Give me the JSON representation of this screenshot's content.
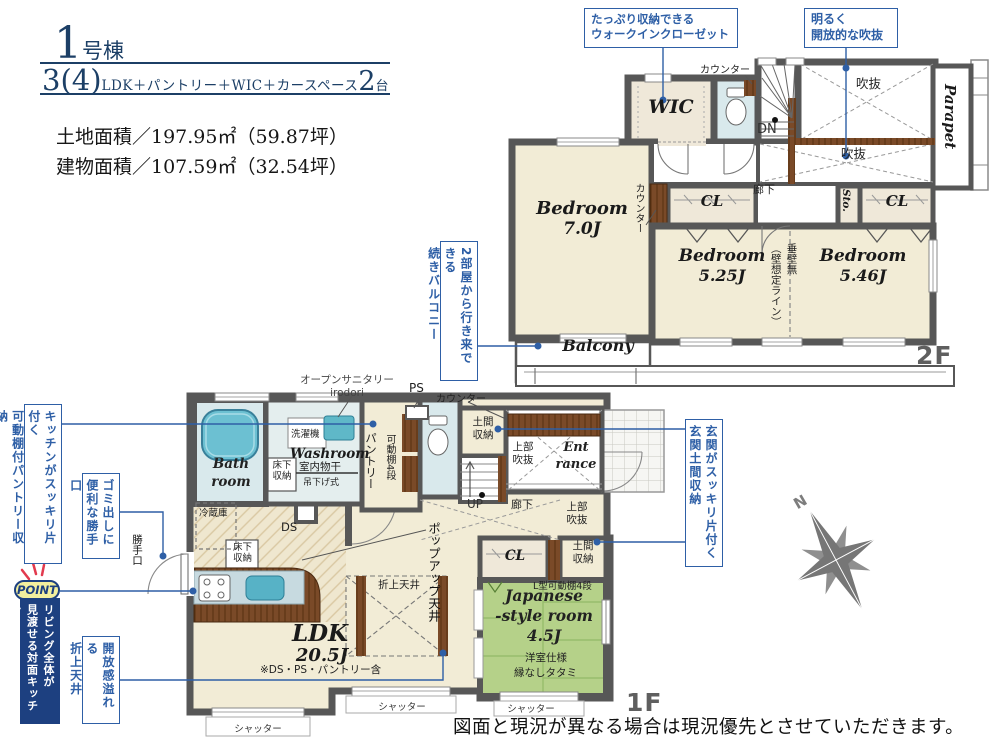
{
  "palette": {
    "accent": "#2e5fa6",
    "navy": "#1c3f66",
    "wall": "#575757",
    "banner": "#1d4080",
    "cream": "#f2ecd6",
    "wet": "#d9e9ec",
    "wood": "#7a4a28",
    "tatami": "#b5d189",
    "pointy": "#f3ef9e"
  },
  "header": {
    "no": "1",
    "no_unit": "号棟",
    "plan_count": "3(4)",
    "plan_text": "LDK＋パントリー＋WIC＋カースペース",
    "cars": "2",
    "cars_unit": "台",
    "land": "土地面積／197.95㎡（59.87坪）",
    "building": "建物面積／107.59㎡（32.54坪）"
  },
  "callouts": {
    "wic": "たっぷり収納できる\nウォークインクローゼット",
    "void": "明るく\n開放的な吹抜",
    "balcony": "2部屋から行き来できる\n続きバルコニー",
    "pantry": "キッチンがスッキリ片付く\n可動棚付パントリー収納",
    "back_door": "ゴミ出しに\n便利な勝手口",
    "point": "POINT",
    "living": "リビング全体が\n見渡せる対面キッチン",
    "ceiling": "開放感溢れる\n折上天井",
    "entrance": "玄関がスッキリ片付く\n玄関土間収納"
  },
  "shared": {
    "counter": "カウンター",
    "cl": "CL",
    "void": "吹抜",
    "corridor": "廊下",
    "shutter": "シャッター",
    "doma": "土間\n収納",
    "upper_void": "上部\n吹抜",
    "underfloor": "床下\n収納",
    "bedroom": "Bedroom"
  },
  "f2": {
    "label": "2F",
    "wic": "WIC",
    "dn": "DN",
    "sto": "Sto.",
    "parapet": "Parapet",
    "bed1": "7.0J",
    "bed2": "5.25J",
    "bed3": "5.46J",
    "wall_note": "垂壁無\n（壁想定ライン）",
    "balcony": "Balcony"
  },
  "f1": {
    "label": "1F",
    "open_sanitary": "オープンサニタリー\nirodori",
    "ps": "PS",
    "bath": "Bath\nroom",
    "washroom": "Washroom",
    "washer": "洗濯機",
    "indoor_dry": "室内物干",
    "hanging": "吊下げ式",
    "pantry": "パントリー",
    "shelf": "可動棚4段",
    "entrance": "Ent\nrance",
    "up": "UP",
    "fridge": "冷蔵庫",
    "ds": "DS",
    "popup": "ポップアップ天井",
    "coffered": "折上天井",
    "ldk": "LDK",
    "ldk_size": "20.5J",
    "ldk_note": "※DS・PS・パントリー含",
    "l_shelf": "L型可動棚4段",
    "jp_room": "Japanese\n-style room\n4.5J",
    "jp_note1": "洋室仕様",
    "jp_note2": "縁なしタタミ",
    "back_door": "勝手口"
  },
  "compass": {
    "n": "N"
  },
  "disclaimer": "図面と現況が異なる場合は現況優先とさせていただきます。"
}
